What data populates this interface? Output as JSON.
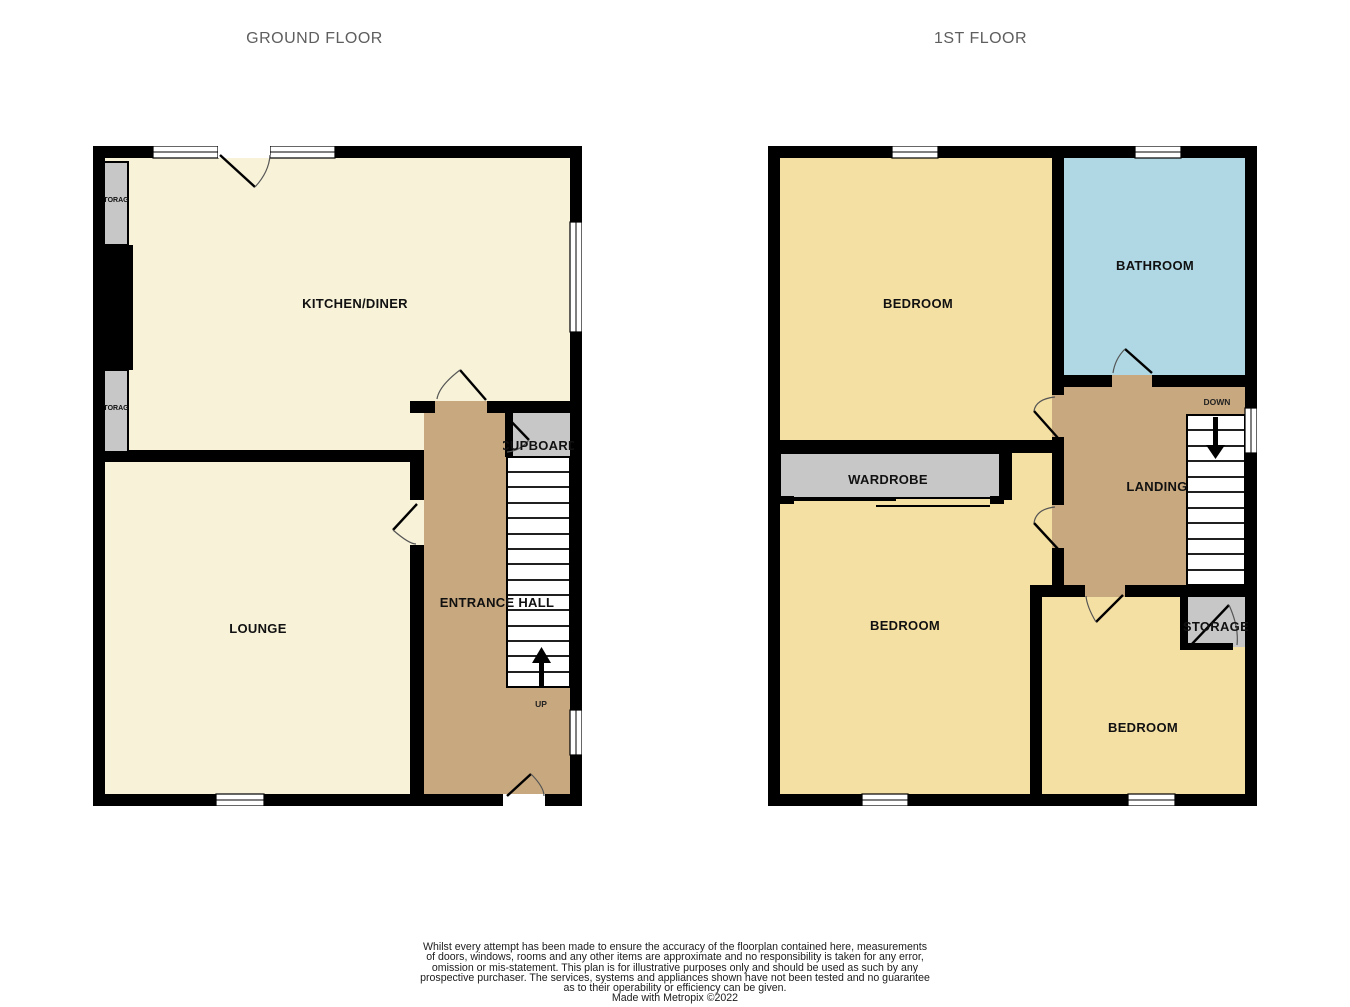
{
  "page": {
    "titles": {
      "ground_floor": "GROUND FLOOR",
      "first_floor": "1ST FLOOR"
    }
  },
  "ground_floor": {
    "rooms": {
      "kitchen_diner": "KITCHEN/DINER",
      "lounge": "LOUNGE",
      "entrance_hall": "ENTRANCE HALL",
      "cupboard": "CUPBOARD",
      "storage_upper": "STORAGE",
      "storage_lower": "STORAGE"
    },
    "stairs_label": "UP"
  },
  "first_floor": {
    "rooms": {
      "bedroom_front": "BEDROOM",
      "bathroom": "BATHROOM",
      "landing": "LANDING",
      "wardrobe": "WARDROBE",
      "bedroom_rear_left": "BEDROOM",
      "bedroom_rear_right": "BEDROOM",
      "storage": "STORAGE"
    },
    "stairs_label": "DOWN"
  },
  "footer": {
    "disclaimer_lines": [
      "Whilst every attempt has been made to ensure the accuracy of the floorplan contained here, measurements",
      "of doors, windows, rooms and any other items are approximate and no responsibility is taken for any error,",
      "omission or mis-statement. This plan is for illustrative purposes only and should be used as such by any",
      "prospective purchaser. The services, systems and appliances shown have not been tested and no guarantee",
      "as to their operability or efficiency can be given."
    ],
    "credit": "Made with Metropix ©2022"
  },
  "colors": {
    "wall": "#000000",
    "ground_room": "#F7F2D8",
    "first_room": "#F5E0A3",
    "bathroom": "#AFD8E4",
    "hall": "#C8A87E",
    "storage": "#C7C7C7",
    "stairs": "#FFFFFF",
    "title_text": "#5E5E5E"
  }
}
